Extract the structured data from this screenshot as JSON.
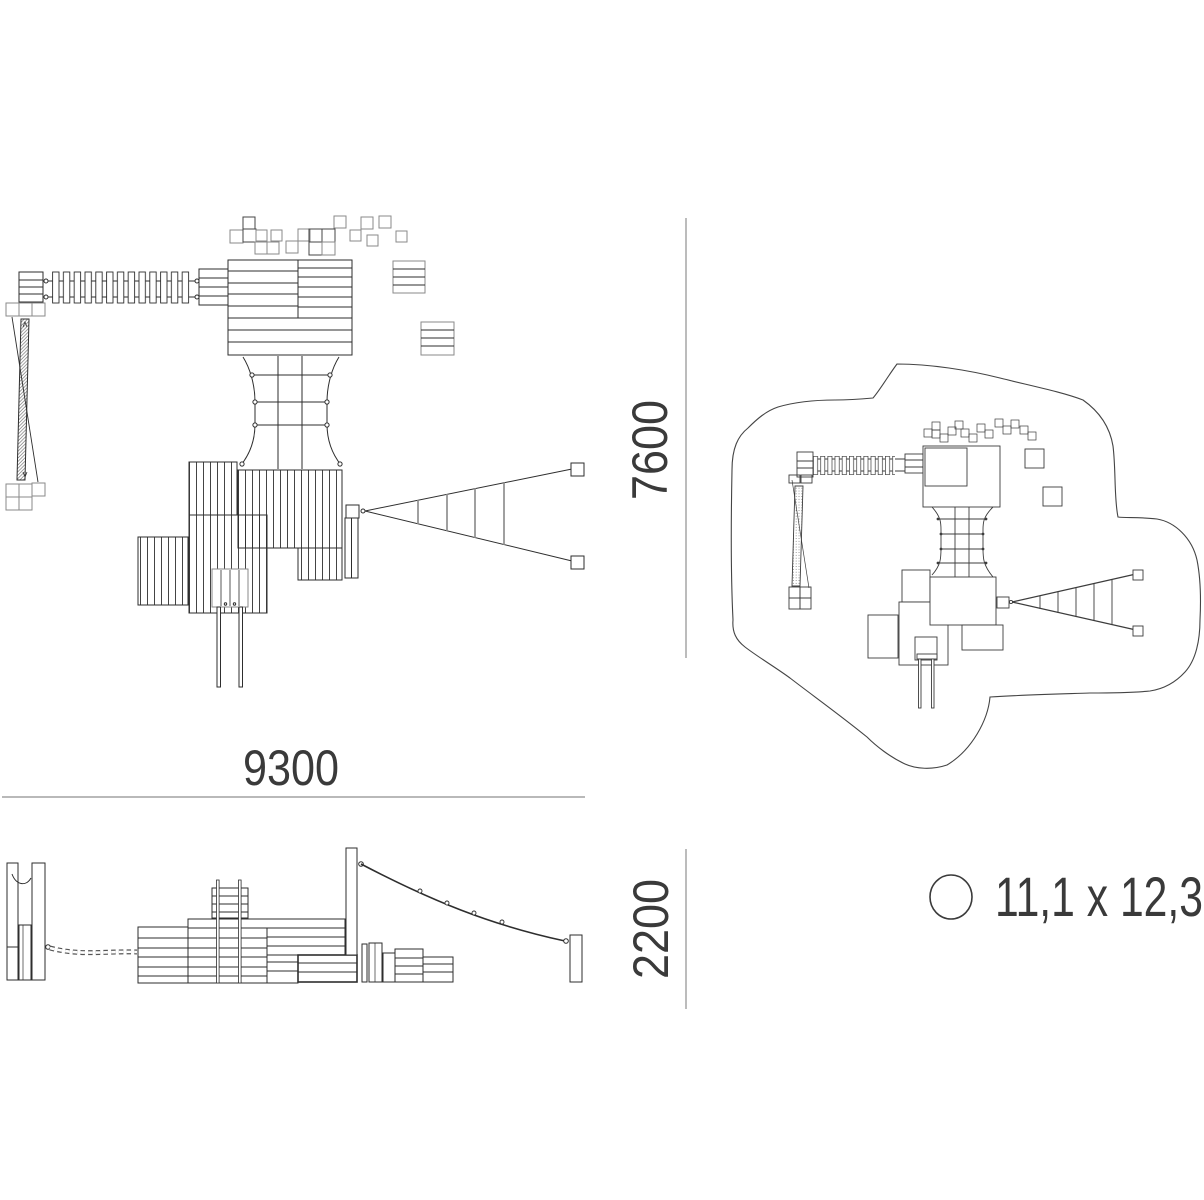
{
  "dimensions": {
    "width_mm": "9300",
    "depth_mm": "7600",
    "height_mm": "2200"
  },
  "footprint": {
    "label": "11,1 x 12,3",
    "icon": "circle-icon"
  },
  "colors": {
    "line_dark": "#2e2e2e",
    "line_gray": "#8a8a8a",
    "dim_line": "#8f8f8f",
    "text": "#3a3a3a",
    "background": "#ffffff"
  }
}
